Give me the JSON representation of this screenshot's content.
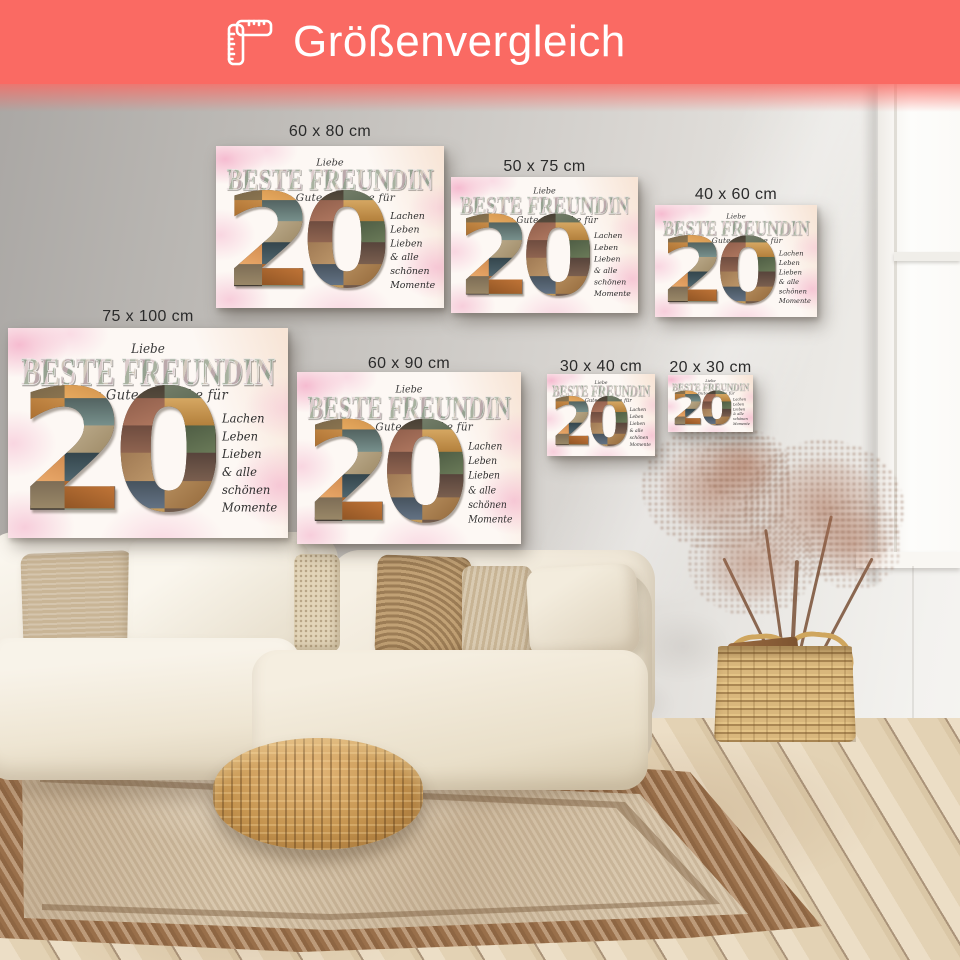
{
  "header": {
    "title": "Größenvergleich",
    "icon": "ruler-icon",
    "bg_color": "#fa6a63",
    "text_color": "#ffffff"
  },
  "prints": [
    {
      "label": "60 x 80 cm"
    },
    {
      "label": "50 x 75 cm"
    },
    {
      "label": "40 x 60 cm"
    },
    {
      "label": "75 x 100 cm"
    },
    {
      "label": "60 x 90 cm"
    },
    {
      "label": "30 x 40 cm"
    },
    {
      "label": "20 x 30 cm"
    }
  ],
  "artwork": {
    "line_small": "Liebe",
    "title": "BESTE FREUNDIN",
    "subtitle": "Alles Gute & Danke für",
    "number": "20",
    "side_lines": [
      "Lachen",
      "Leben",
      "Lieben",
      "& alle",
      "schönen",
      "Momente"
    ]
  }
}
